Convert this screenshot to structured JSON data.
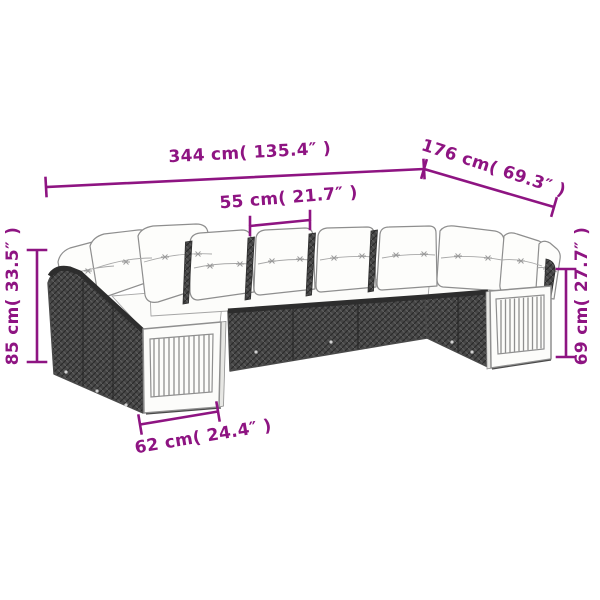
{
  "accent_color": "#8E1482",
  "line_art_palette": {
    "rattan_dark": "#454545",
    "rattan_light": "#5d5d5d",
    "outline_gray": "#8f8f8f",
    "cushion_white": "#fdfdfb"
  },
  "product_diagram": {
    "subject": "rattan garden lounge sofa set with cushions, dimension drawing",
    "measurements": {
      "total_width": "344 cm( 135.4″ )",
      "total_depth": "176 cm( 69.3″ )",
      "seat_width": "55 cm( 21.7″ )",
      "back_height": "85 cm( 33.5″ )",
      "arm_height": "69 cm( 27.7″ )",
      "arm_depth": "62 cm( 24.4″ )"
    }
  }
}
